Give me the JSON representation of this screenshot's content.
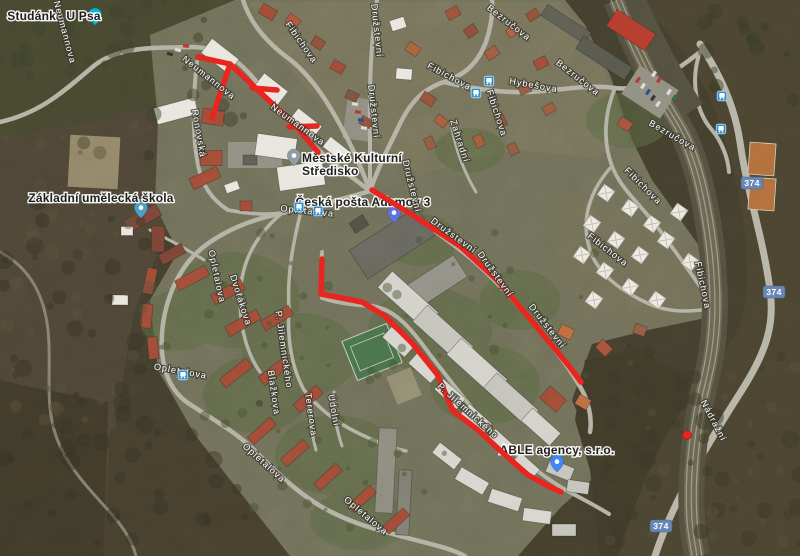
{
  "map": {
    "view_type": "satellite",
    "route_color": "#e8261f",
    "poi_labels": [
      {
        "name": "studanka-u-psa",
        "lines": [
          "Studánka U Psa"
        ],
        "x": 54,
        "y": 20,
        "anchor": "middle",
        "pin": {
          "x": 95,
          "y": 8,
          "color": "#00b9d7"
        }
      },
      {
        "name": "zakladni-umelecka-skola",
        "lines": [
          "Základní umělecká škola"
        ],
        "x": 101,
        "y": 202,
        "anchor": "middle",
        "pin": {
          "x": 141,
          "y": 201,
          "color": "#4e9ec6"
        }
      },
      {
        "name": "mestske-kulturni-stredisko",
        "lines": [
          "Městské Kulturní",
          "Středisko"
        ],
        "x": 302,
        "y": 162,
        "anchor": "start",
        "pin": {
          "x": 294,
          "y": 149,
          "color": "#909ba3"
        }
      },
      {
        "name": "ceska-posta-adamov-3",
        "lines": [
          "Česká pošta Adamov 3"
        ],
        "x": 363,
        "y": 206,
        "anchor": "middle",
        "pin": {
          "x": 394,
          "y": 206,
          "color": "#5f74d8"
        }
      },
      {
        "name": "able-agency-sro",
        "lines": [
          "ABLE agency, s.r.o."
        ],
        "x": 557,
        "y": 454,
        "anchor": "middle",
        "pin": {
          "x": 557,
          "y": 455,
          "color": "#4285f4"
        }
      }
    ],
    "street_labels": [
      {
        "text": "Neumannova",
        "x": 62,
        "y": 33,
        "rot": 75
      },
      {
        "text": "Neumannova",
        "x": 207,
        "y": 80,
        "rot": 38
      },
      {
        "text": "Neumannova",
        "x": 296,
        "y": 127,
        "rot": 36
      },
      {
        "text": "Ronovská",
        "x": 196,
        "y": 134,
        "rot": 80
      },
      {
        "text": "Fibichova",
        "x": 299,
        "y": 44,
        "rot": 55
      },
      {
        "text": "Fibichova",
        "x": 448,
        "y": 79,
        "rot": 28
      },
      {
        "text": "Fibichova",
        "x": 494,
        "y": 114,
        "rot": 72
      },
      {
        "text": "Fibichova",
        "x": 641,
        "y": 188,
        "rot": 45
      },
      {
        "text": "Fibichova",
        "x": 606,
        "y": 252,
        "rot": 38
      },
      {
        "text": "Fibichova",
        "x": 700,
        "y": 286,
        "rot": 78
      },
      {
        "text": "Družstevní",
        "x": 374,
        "y": 31,
        "rot": 84
      },
      {
        "text": "Družstevní",
        "x": 371,
        "y": 112,
        "rot": 84
      },
      {
        "text": "Družstevní",
        "x": 409,
        "y": 187,
        "rot": 76
      },
      {
        "text": "Družstevní",
        "x": 452,
        "y": 238,
        "rot": 36
      },
      {
        "text": "Družstevní",
        "x": 493,
        "y": 276,
        "rot": 54
      },
      {
        "text": "Družstevní",
        "x": 545,
        "y": 328,
        "rot": 52
      },
      {
        "text": "Hybešova",
        "x": 533,
        "y": 88,
        "rot": 10
      },
      {
        "text": "Bezručova",
        "x": 507,
        "y": 25,
        "rot": 38
      },
      {
        "text": "Bezručova",
        "x": 576,
        "y": 80,
        "rot": 38
      },
      {
        "text": "Bezručova",
        "x": 671,
        "y": 138,
        "rot": 30
      },
      {
        "text": "Zahradní",
        "x": 457,
        "y": 142,
        "rot": 72
      },
      {
        "text": "Opletalova",
        "x": 307,
        "y": 214,
        "rot": 6
      },
      {
        "text": "Opletalova",
        "x": 214,
        "y": 277,
        "rot": 78
      },
      {
        "text": "Opletalova",
        "x": 180,
        "y": 374,
        "rot": 10
      },
      {
        "text": "Opletalova",
        "x": 262,
        "y": 465,
        "rot": 42
      },
      {
        "text": "Opletalova",
        "x": 364,
        "y": 518,
        "rot": 40
      },
      {
        "text": "Dvořákova",
        "x": 238,
        "y": 301,
        "rot": 72
      },
      {
        "text": "P. Jilemnického",
        "x": 281,
        "y": 350,
        "rot": 82
      },
      {
        "text": "P. Jilemnického",
        "x": 466,
        "y": 413,
        "rot": 42
      },
      {
        "text": "Blažkova",
        "x": 271,
        "y": 393,
        "rot": 82
      },
      {
        "text": "Tererova",
        "x": 308,
        "y": 415,
        "rot": 82
      },
      {
        "text": "Údolní",
        "x": 331,
        "y": 411,
        "rot": 80
      },
      {
        "text": "Nádražní",
        "x": 711,
        "y": 422,
        "rot": 62
      }
    ],
    "road_badges": [
      {
        "text": "374",
        "x": 752,
        "y": 183
      },
      {
        "text": "374",
        "x": 774,
        "y": 292
      },
      {
        "text": "374",
        "x": 661,
        "y": 526
      }
    ],
    "bus_stops": [
      {
        "x": 299,
        "y": 207
      },
      {
        "x": 318,
        "y": 211
      },
      {
        "x": 183,
        "y": 375
      },
      {
        "x": 476,
        "y": 93
      },
      {
        "x": 489,
        "y": 81
      },
      {
        "x": 722,
        "y": 96
      },
      {
        "x": 721,
        "y": 129
      }
    ],
    "routes": [
      {
        "name": "route-neumannova-main",
        "points": [
          [
            198,
            57
          ],
          [
            230,
            64
          ],
          [
            293,
            123
          ],
          [
            318,
            152
          ]
        ]
      },
      {
        "name": "route-neumannova-branch",
        "points": [
          [
            230,
            64
          ],
          [
            221,
            91
          ],
          [
            212,
            118
          ]
        ]
      },
      {
        "name": "route-neumannova-spur-1",
        "points": [
          [
            252,
            88
          ],
          [
            277,
            90
          ]
        ]
      },
      {
        "name": "route-neumannova-spur-2",
        "points": [
          [
            289,
            127
          ],
          [
            317,
            126
          ]
        ]
      },
      {
        "name": "route-jilemnickeho",
        "points": [
          [
            322,
            259
          ],
          [
            321,
            294
          ],
          [
            362,
            302
          ],
          [
            385,
            316
          ],
          [
            412,
            343
          ],
          [
            437,
            374
          ],
          [
            453,
            411
          ],
          [
            478,
            430
          ],
          [
            503,
            453
          ],
          [
            528,
            475
          ],
          [
            550,
            487
          ],
          [
            561,
            492
          ]
        ]
      },
      {
        "name": "route-druzstevni",
        "points": [
          [
            372,
            190
          ],
          [
            414,
            216
          ],
          [
            461,
            247
          ],
          [
            497,
            280
          ],
          [
            526,
            314
          ],
          [
            550,
            343
          ],
          [
            569,
            366
          ],
          [
            581,
            382
          ]
        ]
      }
    ],
    "point_marker": {
      "x": 687,
      "y": 435
    }
  }
}
